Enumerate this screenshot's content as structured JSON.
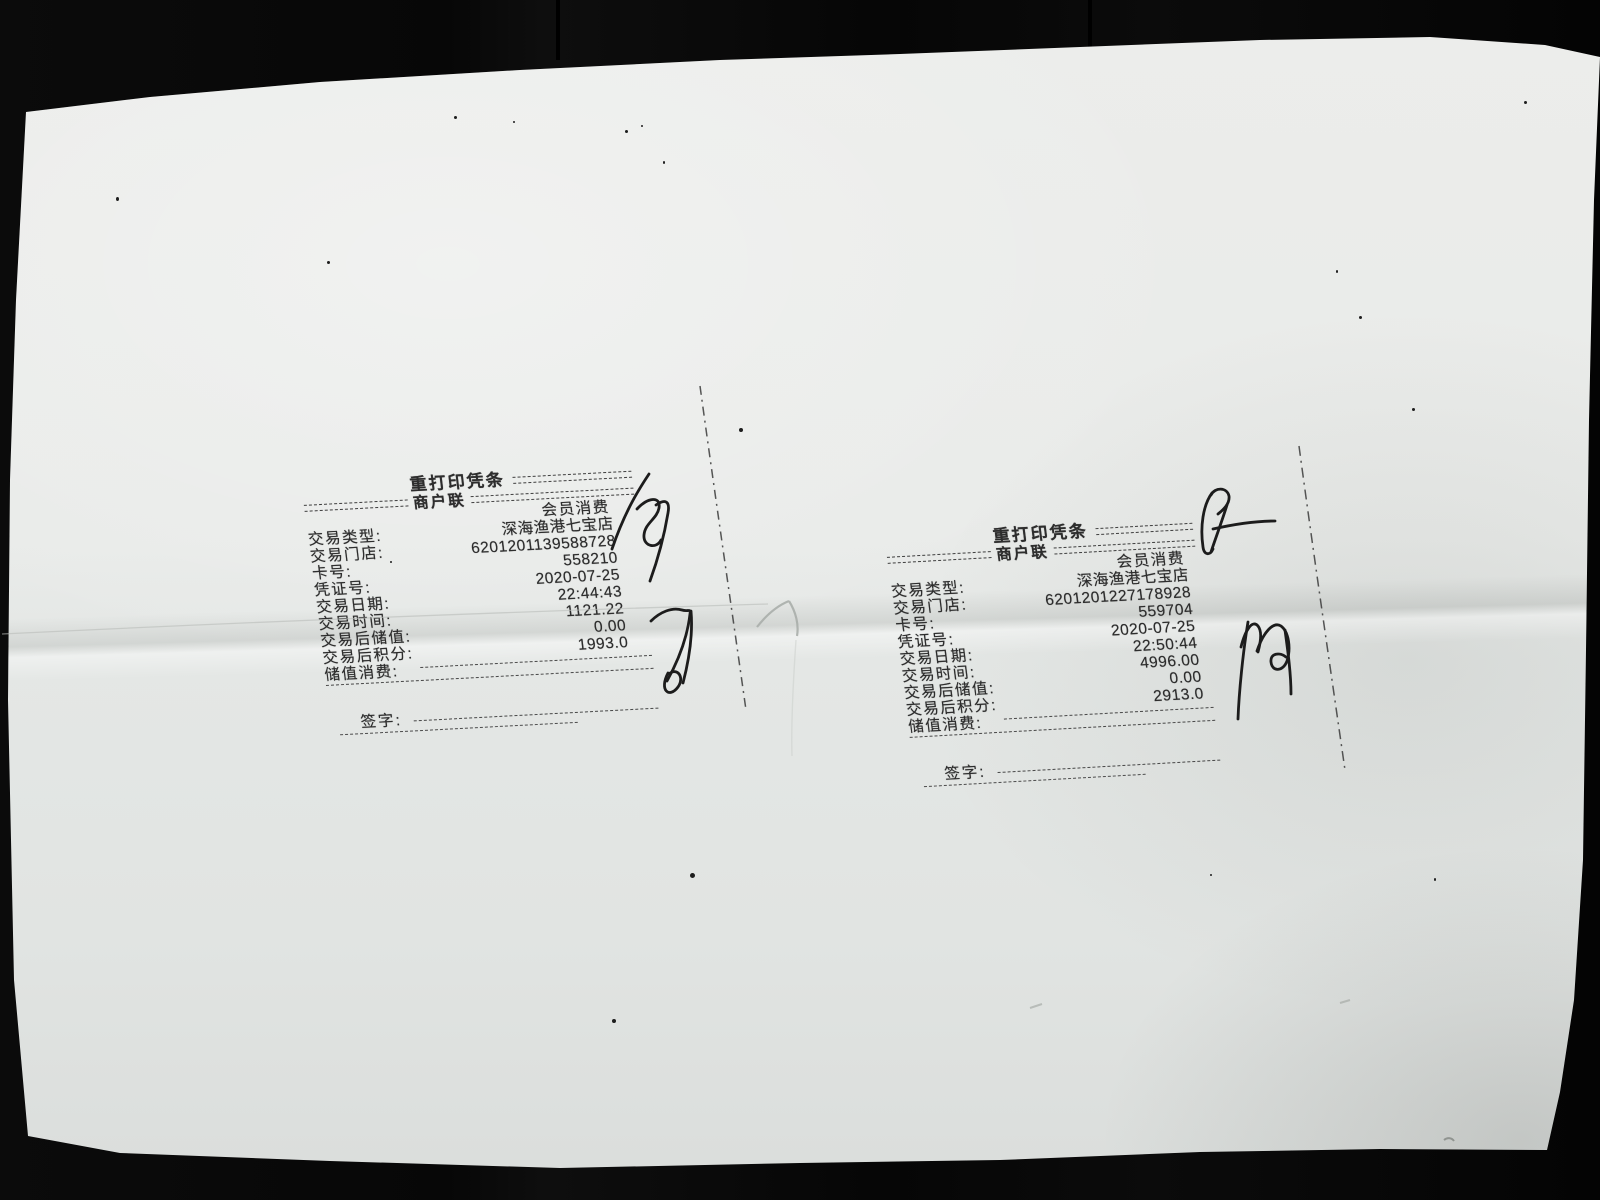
{
  "colors": {
    "paper": "#e8eae8",
    "background": "#070707",
    "ink": "#2d2d2d"
  },
  "receipts": [
    {
      "title": "重打印凭条",
      "copy_label": "商户联",
      "member_type": "会员消费",
      "rows": [
        {
          "label": "交易类型:",
          "value": "深海渔港七宝店"
        },
        {
          "label": "交易门店:",
          "value": "6201201139588728"
        },
        {
          "label": "卡号:",
          "value": "558210"
        },
        {
          "label": "凭证号:",
          "value": "2020-07-25"
        },
        {
          "label": "交易日期:",
          "value": "22:44:43"
        },
        {
          "label": "交易时间:",
          "value": "1121.22"
        },
        {
          "label": "交易后储值:",
          "value": "0.00"
        },
        {
          "label": "交易后积分:",
          "value": "1993.0"
        },
        {
          "label": "储值消费:",
          "value": ""
        }
      ],
      "signature_label": "签字:"
    },
    {
      "title": "重打印凭条",
      "copy_label": "商户联",
      "member_type": "会员消费",
      "rows": [
        {
          "label": "交易类型:",
          "value": "深海渔港七宝店"
        },
        {
          "label": "交易门店:",
          "value": "6201201227178928"
        },
        {
          "label": "卡号:",
          "value": "559704"
        },
        {
          "label": "凭证号:",
          "value": "2020-07-25"
        },
        {
          "label": "交易日期:",
          "value": "22:50:44"
        },
        {
          "label": "交易时间:",
          "value": "4996.00"
        },
        {
          "label": "交易后储值:",
          "value": "0.00"
        },
        {
          "label": "交易后积分:",
          "value": "2913.0"
        },
        {
          "label": "储值消费:",
          "value": ""
        }
      ],
      "signature_label": "签字:"
    }
  ]
}
